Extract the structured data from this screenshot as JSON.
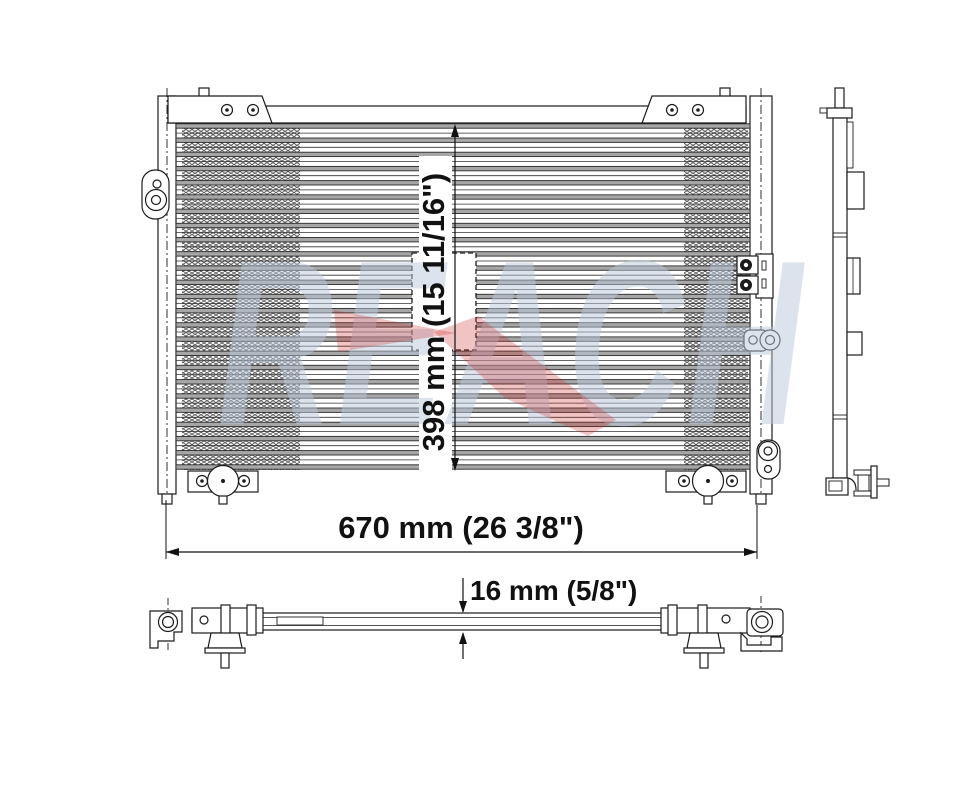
{
  "drawing": {
    "watermark": {
      "text": "REACH"
    },
    "dimensions": {
      "height": {
        "label": "398 mm (15 11/16\")"
      },
      "width": {
        "label": "670 mm (26 3/8\")"
      },
      "depth": {
        "label": "16 mm (5/8\")"
      }
    },
    "front_view": {
      "tube_rows": 25
    },
    "colors": {
      "line": "#1c1c1c",
      "tube_fill": "#a6a6a6",
      "fin": "#575757",
      "watermark_letters": "#bdc9db",
      "watermark_arrow": "#cc2b2b"
    }
  }
}
